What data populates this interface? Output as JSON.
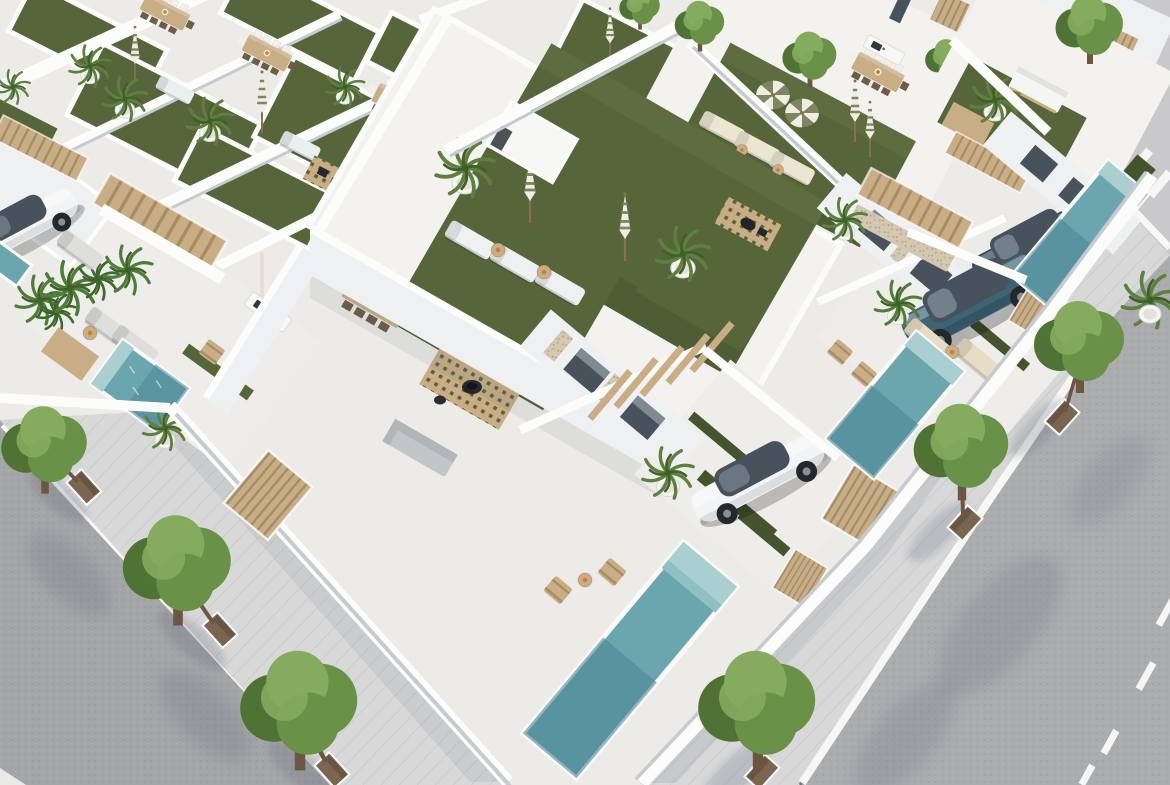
{
  "meta": {
    "description": "Aerial 3D architectural rendering of a modern white villa development: rooftop terraces with artificial lawns, sun loungers and parasols, private pools, parked cars and tree-lined streets on a sunny day"
  },
  "palette": {
    "base": "#edebe7",
    "roofslab": "#f3f2ef",
    "terrace": "#efede9",
    "wallbright": "#fcfcfb",
    "wallface": "#eef0f2",
    "wallshade": "#d7dade",
    "wallshade2": "#c6cad1",
    "sidewalk": "#d8d8d9",
    "curb": "#f7f7f5",
    "asphalt": "#a4a5a7",
    "asphalt2": "#abacae",
    "concrete": "#c9c9cb",
    "grass": "#57663a",
    "grassd": "#46542e",
    "grassl": "#6d7d4c",
    "pool": "#6ba6ae",
    "poold": "#4c8795",
    "pooll": "#a9cfd1",
    "wood": "#c8ad85",
    "woodd": "#a98c63",
    "soil": "#7b6550",
    "trunk": "#6d5640",
    "treem": "#6a9148",
    "treed": "#4e7334",
    "treel": "#85ab5e",
    "palm": "#5d8040",
    "palmd": "#3f6128",
    "carwhite": "#f3f4f5",
    "suvblue": "#3e6374",
    "suvdark": "#2f4a56",
    "glass": "#47525c",
    "wheel": "#23282c",
    "cushion": "#f0f0ee",
    "cream": "#e9dfcc",
    "stone": "#d5c8b2",
    "shadow": "#5c6573",
    "olive": "#7f8560",
    "pot": "#f6f5f2"
  },
  "inventory": {
    "style": "white minimalist Mediterranean villas, aerial oblique view, sun from upper right",
    "rooftop_terraces": 9,
    "rooftop_lawns": 10,
    "private_pools": 5,
    "sun_loungers": 16,
    "closed_parasols": 7,
    "open_parasols": 2,
    "dining_sets": 5,
    "outdoor_kitchens": 2,
    "fire_pit_decks": 2,
    "outdoor_sofas": 2,
    "wooden_staircases": 5,
    "pergolas": 2,
    "slat_gates": 5,
    "potted_palms": 14,
    "street_trees": 6,
    "background_trees": 5,
    "cars": [
      {
        "type": "sedan",
        "color": "white",
        "location": "center driveway"
      },
      {
        "type": "suv",
        "color": "petrol blue",
        "location": "right driveway"
      },
      {
        "type": "suv",
        "color": "dark blue",
        "location": "far right driveway"
      },
      {
        "type": "sedan",
        "color": "white",
        "location": "left carport, partially visible"
      }
    ],
    "streets": 2,
    "lane_markings": "white dashes on right street",
    "crosswalk_marks": 3,
    "tree_planters": 6
  }
}
